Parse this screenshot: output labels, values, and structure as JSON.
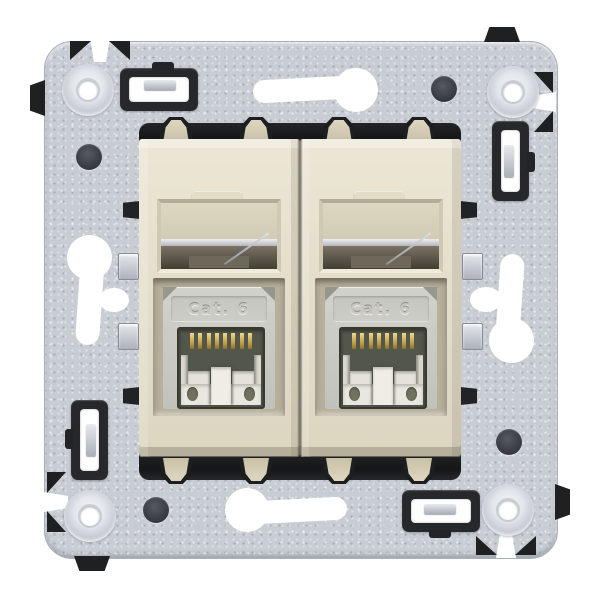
{
  "product_photo": {
    "background_color": "#ffffff",
    "subject_text": {
      "left_module_jack_label": "Cat. 6",
      "right_module_jack_label": "Cat. 6"
    },
    "modules": [
      {
        "jack_label": "Cat. 6"
      },
      {
        "jack_label": "Cat. 6"
      }
    ],
    "colors": {
      "metal_plate": "#c8ccd3",
      "faceplate_beige": "#e4decb",
      "claw_beige": "#d6ceb6",
      "hardware_black": "#232427",
      "jack_face_gray": "#c9c9c3",
      "socket_interior_olive": "#53564a",
      "contact_gold": "#d9b95c",
      "cutout_white": "#ffffff"
    }
  }
}
